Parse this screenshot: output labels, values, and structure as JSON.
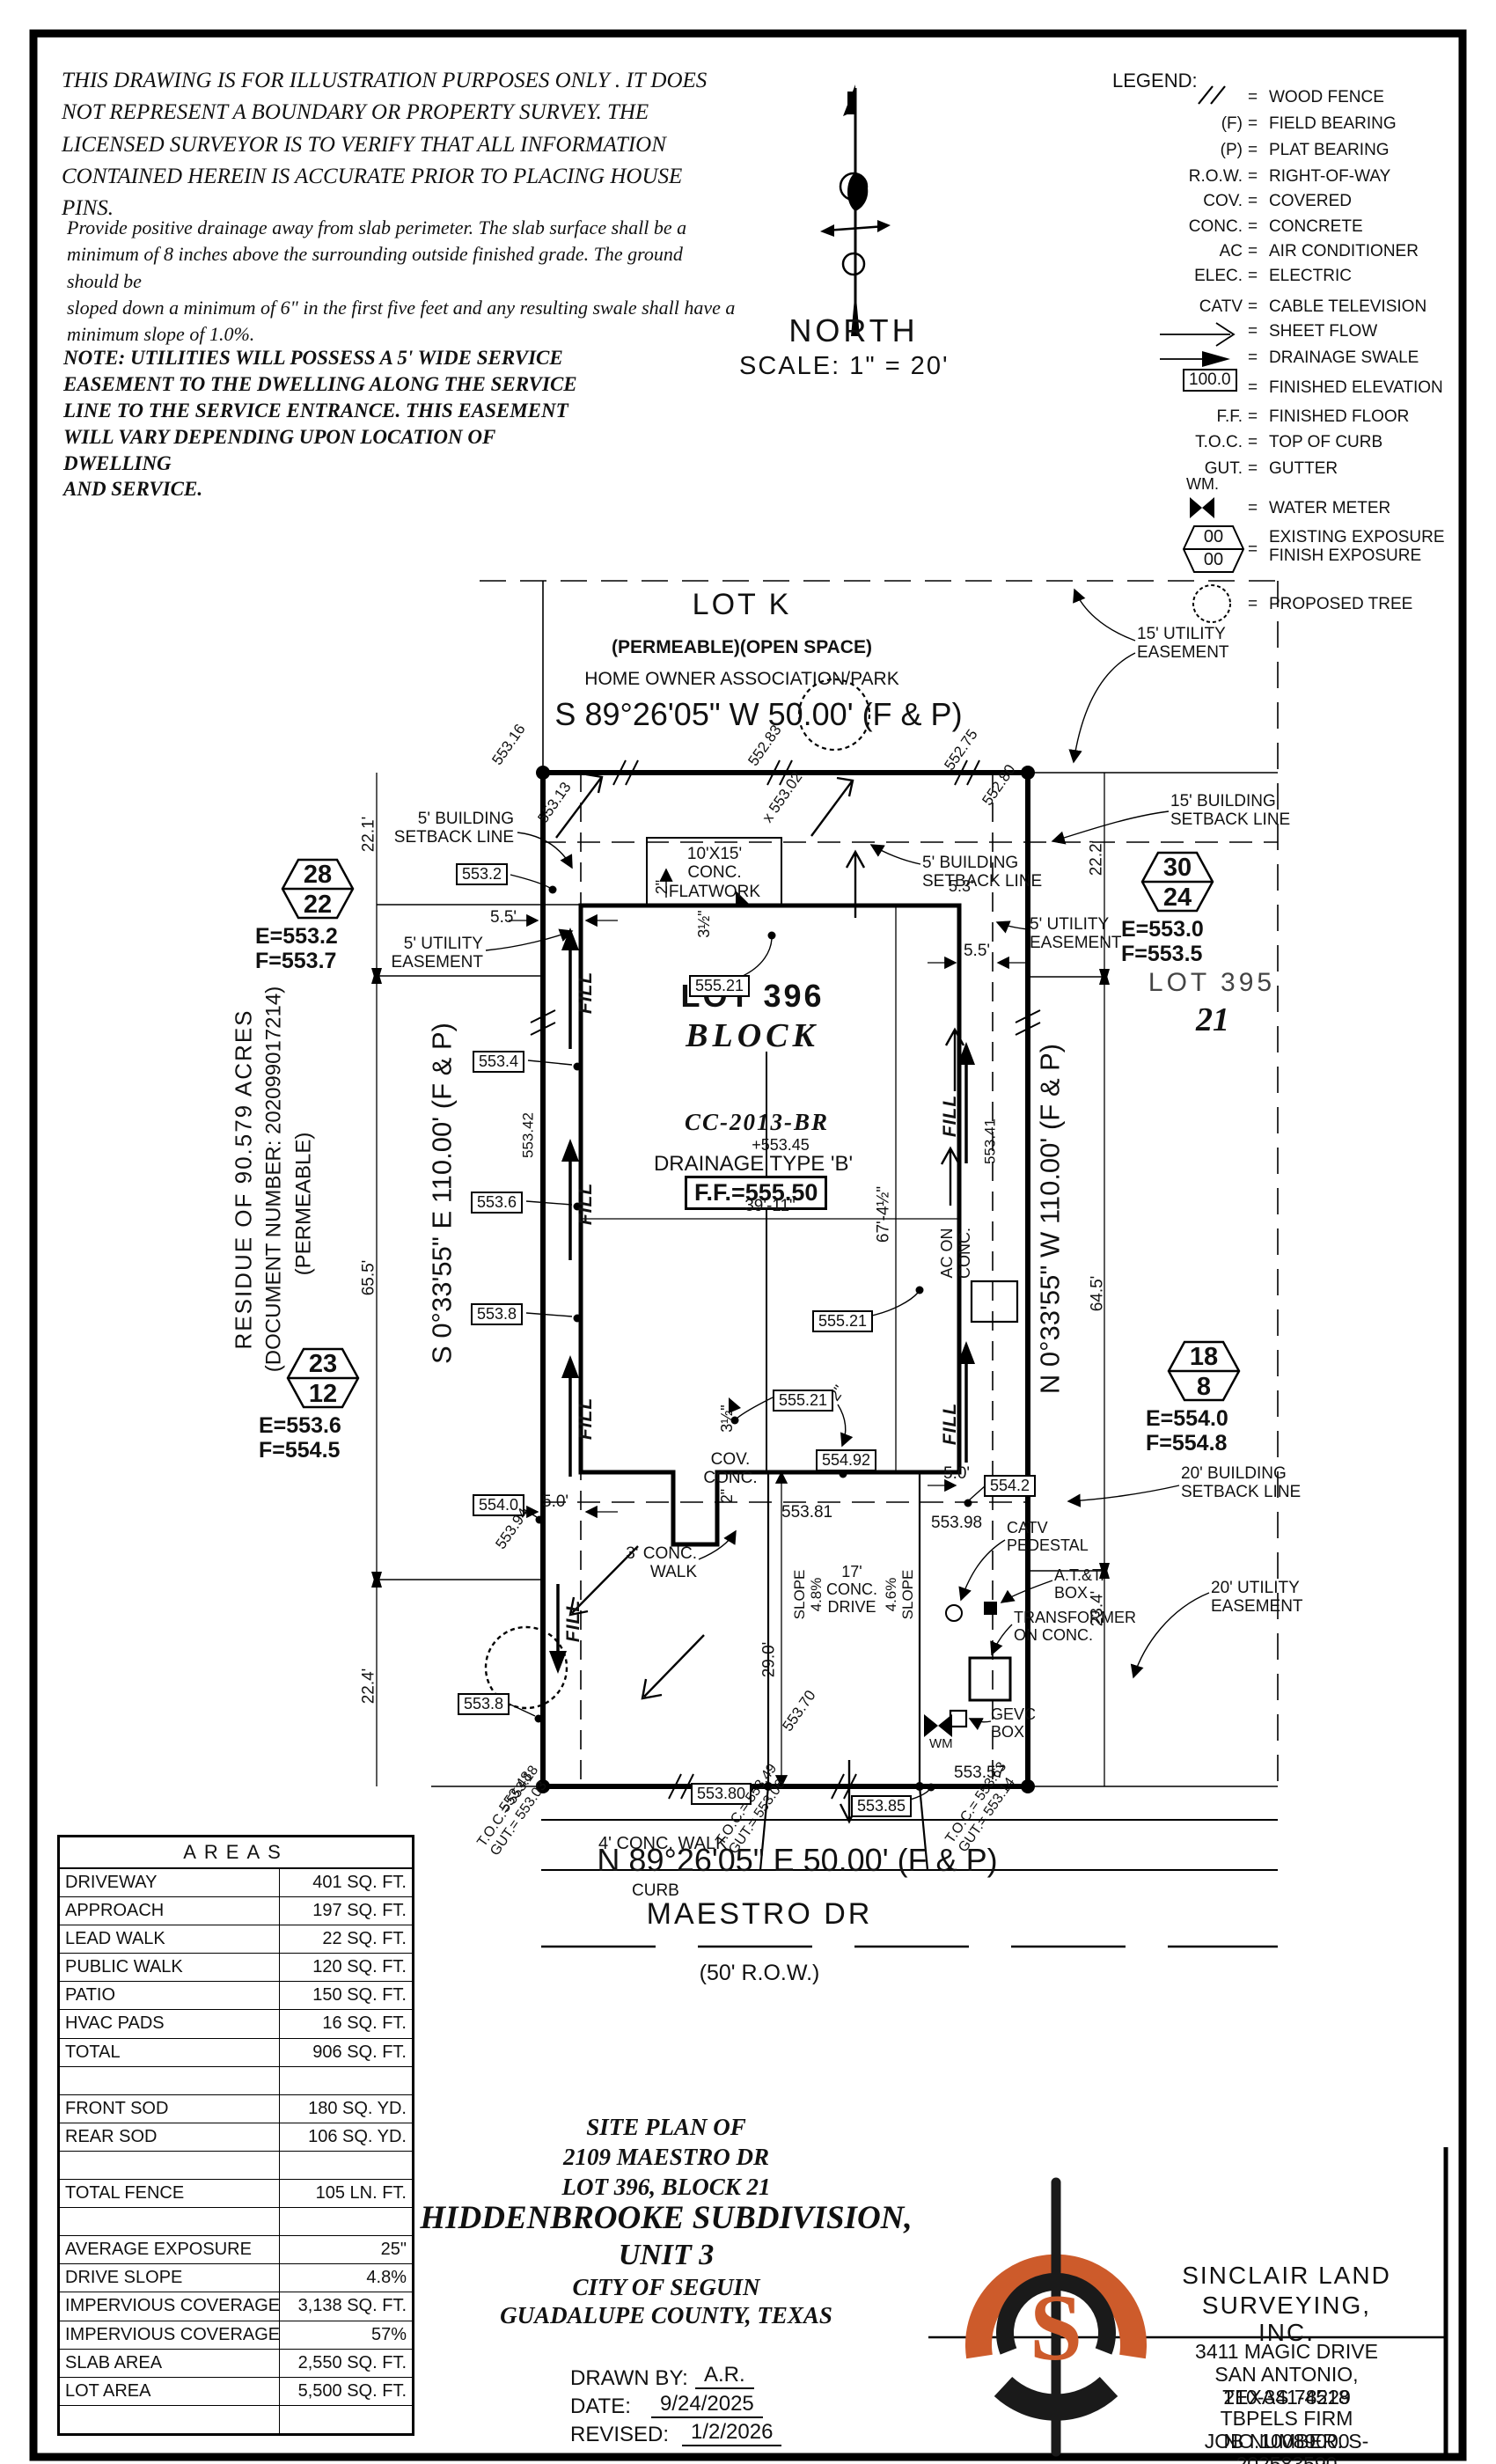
{
  "disclaimer": {
    "p1": "THIS DRAWING IS FOR ILLUSTRATION PURPOSES ONLY . IT DOES\nNOT REPRESENT A BOUNDARY OR PROPERTY SURVEY. THE\nLICENSED SURVEYOR IS TO VERIFY THAT ALL INFORMATION\nCONTAINED HEREIN IS ACCURATE PRIOR TO PLACING HOUSE PINS.",
    "p2": "Provide positive drainage away from slab perimeter. The slab surface shall be a\nminimum of 8 inches above the surrounding outside finished grade. The ground should be\nsloped down a minimum of 6\" in the first five feet and any resulting swale shall have a\nminimum slope of 1.0%.",
    "p3": "NOTE: UTILITIES WILL POSSESS A 5' WIDE SERVICE\nEASEMENT TO THE DWELLING ALONG THE SERVICE\nLINE TO THE SERVICE ENTRANCE. THIS EASEMENT\nWILL VARY DEPENDING UPON LOCATION OF DWELLING\nAND SERVICE."
  },
  "compass": {
    "north": "NORTH",
    "scale": "SCALE:  1\" = 20'"
  },
  "legend": {
    "title": "LEGEND:",
    "eq": "=",
    "fe_value": "100.0",
    "wm_label": "WM.",
    "exp_top": "00",
    "exp_bot": "00",
    "rows": [
      {
        "s": "",
        "l": "WOOD FENCE"
      },
      {
        "s": "(F)",
        "l": "FIELD BEARING"
      },
      {
        "s": "(P)",
        "l": "PLAT BEARING"
      },
      {
        "s": "R.O.W.",
        "l": "RIGHT-OF-WAY"
      },
      {
        "s": "COV.",
        "l": "COVERED"
      },
      {
        "s": "CONC.",
        "l": "CONCRETE"
      },
      {
        "s": "AC",
        "l": "AIR CONDITIONER"
      },
      {
        "s": "ELEC.",
        "l": "ELECTRIC"
      },
      {
        "s": "CATV",
        "l": "CABLE TELEVISION"
      },
      {
        "s": "",
        "l": "SHEET FLOW"
      },
      {
        "s": "",
        "l": "DRAINAGE SWALE"
      },
      {
        "s": "",
        "l": "FINISHED ELEVATION"
      },
      {
        "s": "F.F.",
        "l": "FINISHED FLOOR"
      },
      {
        "s": "T.O.C.",
        "l": "TOP OF CURB"
      },
      {
        "s": "GUT.",
        "l": "GUTTER"
      },
      {
        "s": "",
        "l": "WATER METER"
      },
      {
        "s": "",
        "l": "EXISTING EXPOSURE\nFINISH EXPOSURE"
      },
      {
        "s": "",
        "l": "PROPOSED TREE"
      }
    ]
  },
  "plot": {
    "lotk": "LOT K",
    "lotk_sub": "(PERMEABLE)(OPEN SPACE)",
    "lotk_hoa": "HOME OWNER ASSOCIATION/PARK",
    "brg_top": "S 89°26'05\" W 50.00' (F & P)",
    "brg_bot": "N 89°26'05\" E 50.00' (F & P)",
    "street": "MAESTRO DR",
    "row": "(50' R.O.W.)",
    "lot396": "LOT 396",
    "block": "BLOCK",
    "cc": "CC-2013-BR",
    "spot45": "+553.45",
    "drainage": "DRAINAGE TYPE 'B'",
    "ff": "F.F.=555.50",
    "lot395": "LOT 395",
    "blk21": "21",
    "residue": "RESIDUE OF 90.579 ACRES",
    "docnum": "(DOCUMENT NUMBER: 202099017214)",
    "permeable": "(PERMEABLE)",
    "brg_left": "S 0°33'55\" E 110.00' (F & P)",
    "brg_right": "N 0°33'55\" W 110.00' (F & P)",
    "d221": "22.1'",
    "d655": "65.5'",
    "d224": "22.4'",
    "d222": "22.2'",
    "d645": "64.5'",
    "d234": "23.4'",
    "d55": "5.5'",
    "d53": "5.3'",
    "d50": "5.0'",
    "d3911": "39'-11\"",
    "d674": "67'-4½\"",
    "d290": "29.0'",
    "flat": "10'X15'\nCONC.\nFLATWORK",
    "d2": "2\"",
    "d35": "3½\"",
    "covconc": "COV.\nCONC.",
    "acon": "AC ON\nCONC.",
    "sb5": "5' BUILDING\nSETBACK LINE",
    "sb15": "15' BUILDING\nSETBACK LINE",
    "sb20": "20' BUILDING\nSETBACK LINE",
    "ue5": "5' UTILITY\nEASEMENT",
    "ue15": "15' UTILITY\nEASEMENT",
    "ue20": "20' UTILITY\nEASEMENT",
    "fill": "FILL",
    "e553_2": "553.2",
    "e553_4": "553.4",
    "e553_6": "553.6",
    "e553_8": "553.8",
    "e554_0": "554.0",
    "e554_2": "554.2",
    "e555_21": "555.21",
    "e554_92": "554.92",
    "e553_80": "553.80",
    "e553_85": "553.85",
    "s553_16": "553.16",
    "s553_13": "553.13",
    "s552_83": "552.83",
    "s553_02": "x 553.02",
    "s552_75": "552.75",
    "s552_80": "552.80",
    "s553_42": "553.42",
    "s553_41": "553.41",
    "s553_94": "553.94",
    "s553_81": "553.81",
    "s553_98": "553.98",
    "s553_70": "553.70",
    "s553_48": "553.48",
    "s553_57": "553.57",
    "toc1a": "T.O.C.= 553.18",
    "toc1b": "GUT.= 553.03",
    "toc2a": "T.O.C.= 553.49",
    "toc2b": "GUT.= 553.06",
    "toc3a": "T.O.C.= 553.63",
    "toc3b": "GUT.= 553.14",
    "walk3": "3' CONC.\nWALK",
    "walk4": "4' CONC. WALK",
    "curb": "CURB",
    "slope48": "SLOPE\n4.8%",
    "drive17": "17'\nCONC.\nDRIVE",
    "slope46": "4.6%\nSLOPE",
    "catv": "CATV\nPEDESTAL",
    "att": "A.T.&T.\nBOX",
    "xfmr": "TRANSFORMER\nON CONC.",
    "gevc": "GEVC\nBOX",
    "wm": "WM",
    "hex28": {
      "t": "28",
      "b": "22",
      "e": "E=553.2",
      "f": "F=553.7"
    },
    "hex23": {
      "t": "23",
      "b": "12",
      "e": "E=553.6",
      "f": "F=554.5"
    },
    "hex30": {
      "t": "30",
      "b": "24",
      "e": "E=553.0",
      "f": "F=553.5"
    },
    "hex18": {
      "t": "18",
      "b": "8",
      "e": "E=554.0",
      "f": "F=554.8"
    }
  },
  "areas": {
    "title": "AREAS",
    "rows": [
      {
        "label": "DRIVEWAY",
        "value": "401 SQ. FT."
      },
      {
        "label": "APPROACH",
        "value": "197 SQ. FT."
      },
      {
        "label": "LEAD WALK",
        "value": "22 SQ. FT."
      },
      {
        "label": "PUBLIC WALK",
        "value": "120 SQ. FT."
      },
      {
        "label": "PATIO",
        "value": "150 SQ. FT."
      },
      {
        "label": "HVAC PADS",
        "value": "16 SQ. FT."
      },
      {
        "label": "TOTAL",
        "value": "906 SQ. FT."
      },
      {
        "label": "",
        "value": ""
      },
      {
        "label": "FRONT SOD",
        "value": "180 SQ. YD."
      },
      {
        "label": "REAR SOD",
        "value": "106 SQ. YD."
      },
      {
        "label": "",
        "value": ""
      },
      {
        "label": "TOTAL FENCE",
        "value": "105 LN. FT."
      },
      {
        "label": "",
        "value": ""
      },
      {
        "label": "AVERAGE EXPOSURE",
        "value": "25\""
      },
      {
        "label": "DRIVE SLOPE",
        "value": "4.8%"
      },
      {
        "label": "IMPERVIOUS COVERAGE",
        "value": "3,138 SQ. FT."
      },
      {
        "label": "IMPERVIOUS COVERAGE %",
        "value": "57%"
      },
      {
        "label": "SLAB AREA",
        "value": "2,550 SQ. FT."
      },
      {
        "label": "LOT AREA",
        "value": "5,500 SQ. FT."
      },
      {
        "label": "",
        "value": ""
      }
    ]
  },
  "title_block": {
    "l1": "SITE PLAN OF",
    "l2": "2109 MAESTRO DR",
    "l3": "LOT 396, BLOCK 21",
    "l4": "HIDDENBROOKE SUBDIVISION,",
    "l5": "UNIT 3",
    "l6": "CITY OF SEGUIN",
    "l7": "GUADALUPE COUNTY, TEXAS",
    "drawn_label": "DRAWN BY:",
    "drawn": "A.R.",
    "date_label": "DATE:",
    "date": "9/24/2025",
    "rev_label": "REVISED:",
    "rev": "1/2/2026"
  },
  "firm": {
    "name1": "SINCLAIR LAND",
    "name2": "SURVEYING, INC.",
    "monogram": "S",
    "addr1": "3411 MAGIC DRIVE",
    "addr2": "SAN ANTONIO, TEXAS 78229",
    "phone": "210-341-4518",
    "lic": "TBPELS FIRM NO.10089000",
    "job": "JOB NUMBER: S-202583590",
    "accent": "#cd5b2b"
  }
}
